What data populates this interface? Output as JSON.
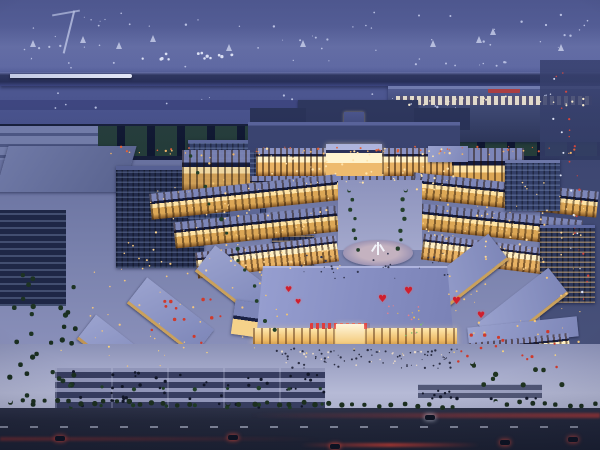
{
  "meta": {
    "description": "Night-time aerial architectural rendering of a large symmetrical European-style commercial plaza complex beside a harbor; illuminated arcades, central monument plaza, front exhibition hall with red heart balloons, waterfront piers with ships, surrounding office blocks, tree-lined roads with traffic light trails",
    "width": 600,
    "height": 450
  },
  "palette": {
    "sky": "#4a5389",
    "sea": "#566098",
    "pier": "#2a3158",
    "industrial": "#151d38",
    "officeDark": "#222b4c",
    "officeMid": "#333f68",
    "roofPale": "#99a2ce",
    "hallRoof": "#8e96ca",
    "warm": "#dca756",
    "warmBright": "#ffe4a6",
    "ground": "#a2a7c8",
    "tree": "#1d3323",
    "road": "#23283b",
    "tailLight": "#d8453a",
    "heart": "#cf1f2e",
    "signRed": "#e03c3c"
  },
  "sign": {
    "type": "red-chinese-character-banner",
    "legible": false,
    "color": "#e03c3c"
  },
  "hearts": [
    [
      285,
      286,
      8
    ],
    [
      295,
      299,
      7
    ],
    [
      378,
      295,
      10
    ],
    [
      404,
      287,
      10
    ],
    [
      452,
      297,
      10
    ],
    [
      477,
      312,
      9
    ]
  ],
  "boats": [
    [
      30,
      40,
      1
    ],
    [
      80,
      36,
      1
    ],
    [
      116,
      42,
      1
    ],
    [
      150,
      35,
      1
    ],
    [
      226,
      44,
      1
    ],
    [
      300,
      40,
      1
    ],
    [
      430,
      40,
      1
    ],
    [
      476,
      36,
      1
    ],
    [
      558,
      44,
      1
    ],
    [
      490,
      28,
      1
    ]
  ],
  "cars": [
    {
      "x": 55,
      "y": 436,
      "glow": "red"
    },
    {
      "x": 228,
      "y": 435,
      "glow": "red"
    },
    {
      "x": 330,
      "y": 444,
      "glow": "red"
    },
    {
      "x": 425,
      "y": 415,
      "glow": "white"
    },
    {
      "x": 500,
      "y": 440,
      "glow": "red"
    },
    {
      "x": 568,
      "y": 437,
      "glow": "red"
    }
  ],
  "dot_fields": [
    {
      "n": "sea-lights-1",
      "t": "rect",
      "x": 10,
      "y": 12,
      "w": 580,
      "h": 18,
      "c": 26,
      "col": "#ccd2ee",
      "s": 1,
      "seed": 1
    },
    {
      "n": "sea-lights-2",
      "t": "rect",
      "x": 20,
      "y": 34,
      "w": 560,
      "h": 16,
      "c": 22,
      "col": "#c6cdea",
      "s": 1,
      "seed": 2
    },
    {
      "n": "sea-lights-3",
      "t": "rect",
      "x": 30,
      "y": 58,
      "w": 540,
      "h": 12,
      "c": 16,
      "col": "#c2c9e8",
      "s": 1,
      "seed": 3
    },
    {
      "n": "sea-lights-4",
      "t": "rect",
      "x": 10,
      "y": 88,
      "w": 580,
      "h": 20,
      "c": 18,
      "col": "#bdc5e4",
      "s": 1,
      "seed": 4
    },
    {
      "n": "pier-lit-structures",
      "t": "rect",
      "x": 140,
      "y": 52,
      "w": 92,
      "h": 7,
      "c": 14,
      "col": "#eef2ff",
      "s": 1.5,
      "seed": 5
    },
    {
      "n": "terminal-lights",
      "t": "rect",
      "x": 408,
      "y": 96,
      "w": 185,
      "h": 9,
      "c": 22,
      "col": "#fdf0cf",
      "s": 1,
      "seed": 6
    },
    {
      "n": "industrial-red-lights",
      "t": "rect",
      "x": 115,
      "y": 146,
      "w": 475,
      "h": 5,
      "c": 34,
      "col": "#e06038",
      "s": 1,
      "seed": 7
    },
    {
      "n": "industrial-amber-lights",
      "t": "rect",
      "x": 110,
      "y": 150,
      "w": 480,
      "h": 4,
      "c": 26,
      "col": "#eeb268",
      "s": 1,
      "seed": 8
    },
    {
      "n": "palace-sparkle",
      "t": "rect",
      "x": 252,
      "y": 148,
      "w": 206,
      "h": 38,
      "c": 55,
      "col": "#ffe3ab",
      "s": 1,
      "seed": 9
    },
    {
      "n": "left-rows-lights",
      "t": "rect",
      "x": 150,
      "y": 184,
      "w": 190,
      "h": 88,
      "c": 60,
      "col": "#ffd794",
      "s": 1,
      "seed": 10
    },
    {
      "n": "right-rows-lights",
      "t": "rect",
      "x": 412,
      "y": 182,
      "w": 175,
      "h": 88,
      "c": 55,
      "col": "#ffd794",
      "s": 1,
      "seed": 11
    },
    {
      "n": "left-wing-windows",
      "t": "rect",
      "x": 85,
      "y": 235,
      "w": 165,
      "h": 135,
      "c": 45,
      "col": "#f3c57c",
      "s": 1,
      "seed": 12
    },
    {
      "n": "right-wing-windows",
      "t": "rect",
      "x": 430,
      "y": 200,
      "w": 150,
      "h": 145,
      "c": 50,
      "col": "#f3c57c",
      "s": 1,
      "seed": 13
    },
    {
      "n": "left-awnings",
      "t": "rect",
      "x": 145,
      "y": 298,
      "w": 85,
      "h": 48,
      "c": 13,
      "col": "#cf3a2c",
      "s": 1.5,
      "seed": 14
    },
    {
      "n": "right-awnings",
      "t": "rect",
      "x": 455,
      "y": 330,
      "w": 105,
      "h": 42,
      "c": 15,
      "col": "#cf3a2c",
      "s": 1.5,
      "seed": 15
    },
    {
      "n": "front-crowd-dark",
      "t": "rect",
      "x": 262,
      "y": 348,
      "w": 195,
      "h": 20,
      "c": 70,
      "col": "#2c2f44",
      "s": 1,
      "seed": 16
    },
    {
      "n": "front-crowd-light",
      "t": "rect",
      "x": 270,
      "y": 350,
      "w": 180,
      "h": 16,
      "c": 22,
      "col": "#e8d8c8",
      "s": 1,
      "seed": 17
    },
    {
      "n": "parking-cars",
      "t": "rect",
      "x": 58,
      "y": 369,
      "w": 265,
      "h": 38,
      "c": 46,
      "col": "#111628",
      "s": 1.8,
      "seed": 18
    },
    {
      "n": "balloon-strings-pink",
      "t": "rect",
      "x": 385,
      "y": 303,
      "w": 40,
      "h": 30,
      "c": 8,
      "col": "#e2808f",
      "s": 1.2,
      "seed": 19
    },
    {
      "n": "balloon-strings-gold",
      "t": "rect",
      "x": 390,
      "y": 308,
      "w": 34,
      "h": 26,
      "c": 6,
      "col": "#e8bb54",
      "s": 1.2,
      "seed": 40
    },
    {
      "n": "balloon-strings-green",
      "t": "rect",
      "x": 395,
      "y": 312,
      "w": 30,
      "h": 24,
      "c": 5,
      "col": "#7cc06c",
      "s": 1.2,
      "seed": 41
    },
    {
      "n": "trees-left-band",
      "t": "rect",
      "x": 12,
      "y": 248,
      "w": 62,
      "h": 150,
      "c": 16,
      "col": "#1d3323",
      "s": 3.5,
      "seed": 20
    },
    {
      "n": "trees-far-left",
      "t": "rect",
      "x": 0,
      "y": 305,
      "w": 80,
      "h": 105,
      "c": 14,
      "col": "#1a2e20",
      "s": 3.5,
      "seed": 21
    },
    {
      "n": "trees-right-plaza",
      "t": "rect",
      "x": 470,
      "y": 360,
      "w": 115,
      "h": 34,
      "c": 9,
      "col": "#203420",
      "s": 3.5,
      "seed": 22
    },
    {
      "n": "parking-trees-1",
      "t": "line",
      "x1": 70,
      "y1": 386,
      "x2": 320,
      "y2": 386,
      "c": 9,
      "col": "#234028",
      "s": 3,
      "j": 2,
      "seed": 23
    },
    {
      "n": "parking-trees-2",
      "t": "line",
      "x1": 70,
      "y1": 404,
      "x2": 320,
      "y2": 404,
      "c": 9,
      "col": "#1f3a24",
      "s": 3,
      "j": 2,
      "seed": 24
    },
    {
      "n": "road-trees-1",
      "t": "line",
      "x1": 8,
      "y1": 399,
      "x2": 186,
      "y2": 402,
      "c": 16,
      "col": "#1c2f1f",
      "s": 3.5,
      "j": 2,
      "seed": 25
    },
    {
      "n": "road-trees-2",
      "t": "line",
      "x1": 226,
      "y1": 401,
      "x2": 452,
      "y2": 404,
      "c": 19,
      "col": "#1c2f1f",
      "s": 3.5,
      "j": 2,
      "seed": 26
    },
    {
      "n": "road-trees-3",
      "t": "line",
      "x1": 494,
      "y1": 401,
      "x2": 592,
      "y2": 403,
      "c": 9,
      "col": "#1c2f1f",
      "s": 3.5,
      "j": 2,
      "seed": 27
    },
    {
      "n": "avenue-lamps",
      "t": "line",
      "x1": 202,
      "y1": 152,
      "x2": 284,
      "y2": 328,
      "c": 22,
      "col": "#f4c571",
      "s": 1.2,
      "j": 7,
      "seed": 28
    },
    {
      "n": "avenue-trees",
      "t": "line",
      "x1": 192,
      "y1": 158,
      "x2": 272,
      "y2": 330,
      "c": 13,
      "col": "#22402a",
      "s": 3,
      "j": 5,
      "seed": 29
    },
    {
      "n": "right-street-taillights",
      "t": "line",
      "x1": 558,
      "y1": 68,
      "x2": 588,
      "y2": 295,
      "c": 20,
      "col": "#d8453a",
      "s": 1.3,
      "j": 6,
      "seed": 30
    },
    {
      "n": "right-street-headlights",
      "t": "line",
      "x1": 552,
      "y1": 75,
      "x2": 580,
      "y2": 290,
      "c": 12,
      "col": "#dfe4f5",
      "s": 1,
      "j": 5,
      "seed": 31
    },
    {
      "n": "promenade-trees-l",
      "t": "line",
      "x1": 348,
      "y1": 188,
      "x2": 356,
      "y2": 248,
      "c": 7,
      "col": "#243f2b",
      "s": 2.5,
      "j": 2,
      "seed": 32
    },
    {
      "n": "promenade-trees-r",
      "t": "line",
      "x1": 404,
      "y1": 188,
      "x2": 398,
      "y2": 248,
      "c": 7,
      "col": "#243f2b",
      "s": 2.5,
      "j": 2,
      "seed": 33
    },
    {
      "n": "plaza-lamps",
      "t": "line",
      "x1": 60,
      "y1": 348,
      "x2": 552,
      "y2": 352,
      "c": 11,
      "col": "#ffd77a",
      "s": 1.3,
      "j": 3,
      "seed": 34
    },
    {
      "n": "center-plaza-crowd",
      "t": "rect",
      "x": 300,
      "y": 252,
      "w": 150,
      "h": 26,
      "c": 30,
      "col": "#343852",
      "s": 1,
      "seed": 35
    },
    {
      "n": "right-parking-cars",
      "t": "rect",
      "x": 420,
      "y": 386,
      "w": 120,
      "h": 12,
      "c": 12,
      "col": "#12172a",
      "s": 1.6,
      "seed": 36
    }
  ]
}
